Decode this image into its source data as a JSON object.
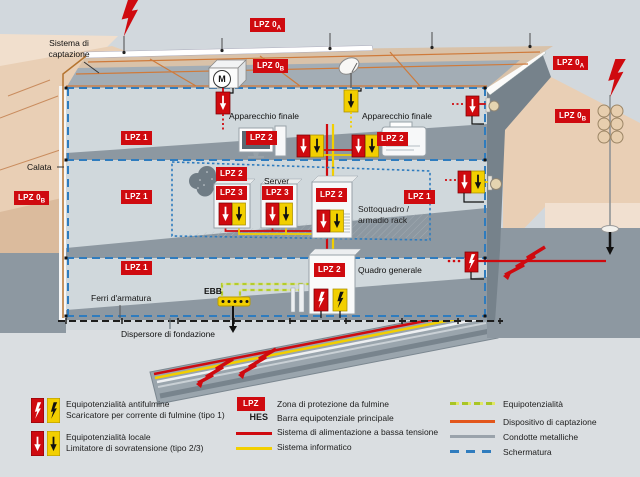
{
  "labels": {
    "sistema1": "Sistema di",
    "sistema2": "captazione",
    "calata": "Calata",
    "apparecchio_finale": "Apparecchio finale",
    "server": "Server",
    "sottoquadro1": "Sottoquadro /",
    "sottoquadro2": "armadio rack",
    "quadro_generale": "Quadro generale",
    "ebb": "EBB",
    "ferri": "Ferri d'armatura",
    "dispersore": "Dispersore di fondazione",
    "motor": "M"
  },
  "badges": {
    "lpz0": "LPZ 0",
    "sub_a": "A",
    "sub_b": "B",
    "lpz1": "LPZ 1",
    "lpz2": "LPZ 2",
    "lpz3": "LPZ 3"
  },
  "legend": {
    "left": [
      {
        "l1": "Equipotenzialità antifulmine",
        "l2": "Scaricatore per corrente di fulmine (tipo 1)"
      },
      {
        "l1": "Equipotenzialità locale",
        "l2": "Limitatore di sovratensione (tipo 2/3)"
      }
    ],
    "mid": {
      "lpz_key": "LPZ",
      "lpz_label": "Zona di protezione da fulmine",
      "hes_key": "HES",
      "hes_label": "Barra equipotenziale principale",
      "power_label": "Sistema di alimentazione a bassa tensione",
      "it_label": "Sistema informatico"
    },
    "right": {
      "equi_label": "Equipotenzialità",
      "capt_label": "Dispositivo di captazione",
      "cond_label": "Condotte metalliche",
      "scherm_label": "Schermatura"
    }
  },
  "colors": {
    "red": "#cf0a0f",
    "yellow": "#f2cf00",
    "blue_shield": "#2f7cbe",
    "orange_capt": "#e2561b",
    "green_equi": "#a9c525",
    "gray_pipe": "#9aa3ab"
  }
}
